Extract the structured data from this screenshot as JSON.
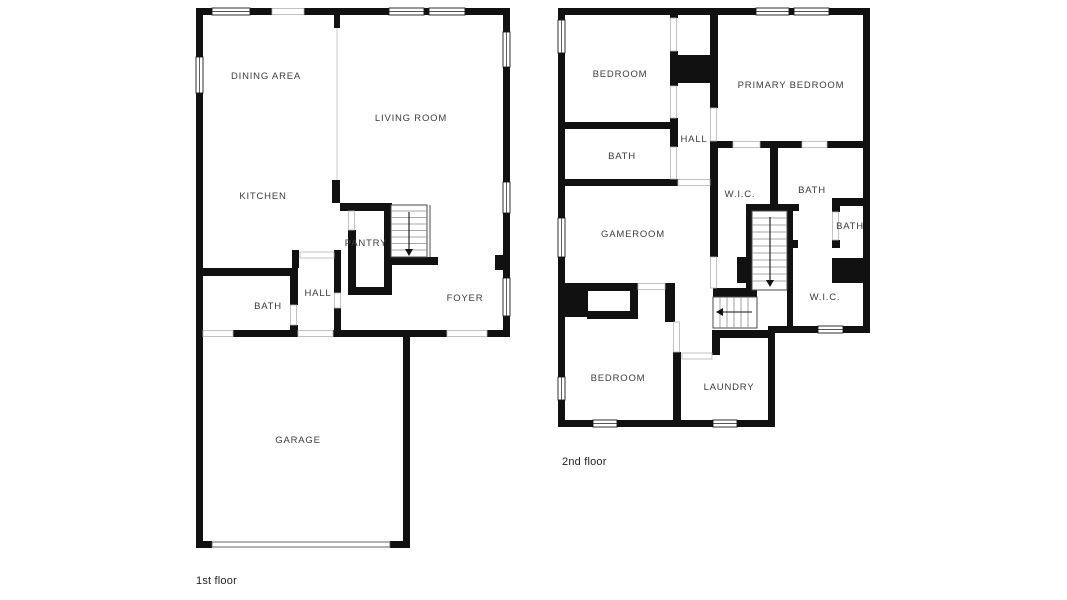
{
  "floor1": {
    "caption": "1st floor",
    "rooms": {
      "dining": "DINING AREA",
      "living": "LIVING ROOM",
      "kitchen": "KITCHEN",
      "pantry": "PANTRY",
      "hall": "HALL",
      "bath": "BATH",
      "foyer": "FOYER",
      "garage": "GARAGE"
    }
  },
  "floor2": {
    "caption": "2nd floor",
    "rooms": {
      "bedroom_top": "BEDROOM",
      "primary": "PRIMARY BEDROOM",
      "bath_left": "BATH",
      "hall": "HALL",
      "wic_upper": "W.I.C.",
      "bath_mid": "BATH",
      "bath_small": "BATH",
      "gameroom": "GAMEROOM",
      "wic_lower": "W.I.C.",
      "bedroom_bottom": "BEDROOM",
      "laundry": "LAUNDRY"
    }
  },
  "colors": {
    "wall": "#111111",
    "room_label": "#3c3c3c",
    "caption": "#1f1f1f",
    "background": "#ffffff"
  }
}
